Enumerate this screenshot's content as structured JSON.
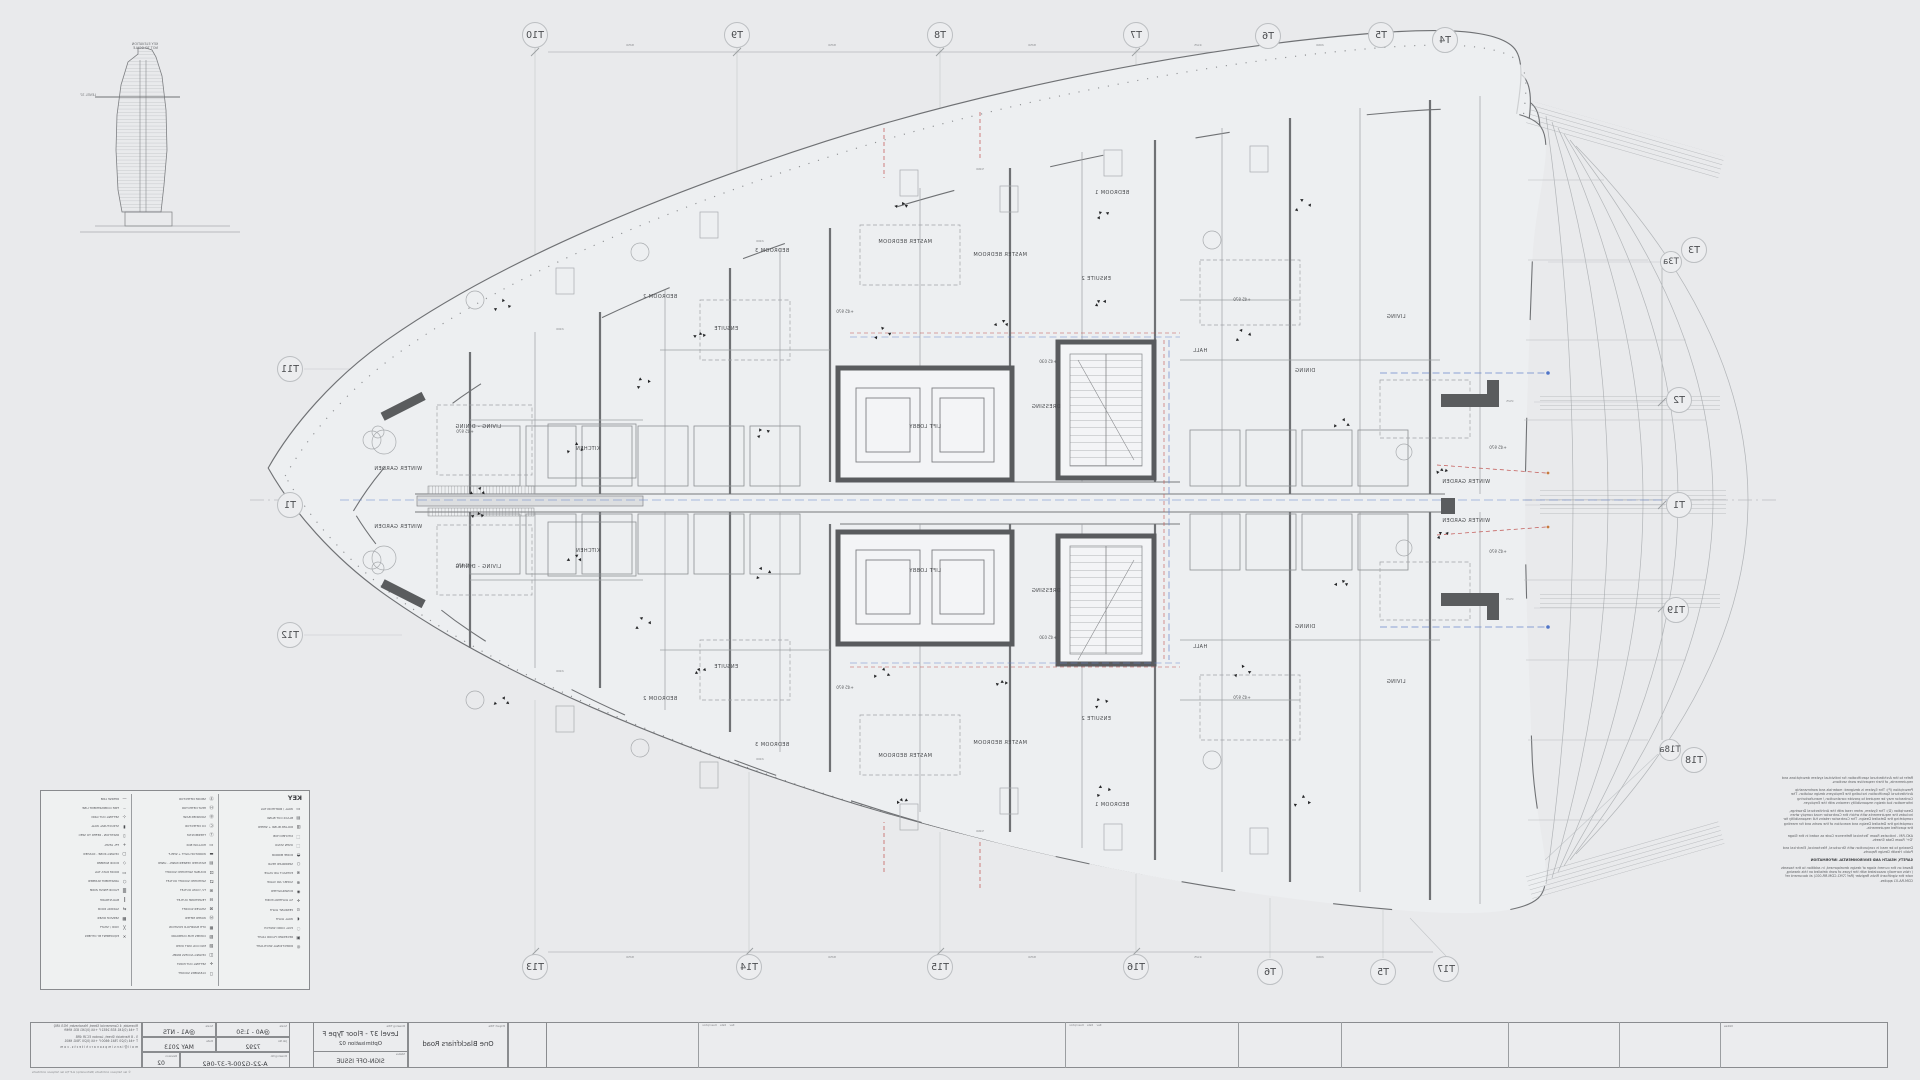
{
  "sheet": {
    "background": "#e9eaec",
    "line_dark": "#6f7174",
    "line_light": "#aeb1b4",
    "accent_blue": "#6a88cc",
    "accent_red": "#c0504d"
  },
  "elevation": {
    "caption_line1": "KEY ELEVATION",
    "caption_line2": "NOT TO SCALE",
    "level_label": "LEVEL 37"
  },
  "grid": {
    "bubbles": [
      {
        "label": "T10",
        "x": 535,
        "y": 35
      },
      {
        "label": "T9",
        "x": 737,
        "y": 35
      },
      {
        "label": "T8",
        "x": 940,
        "y": 35
      },
      {
        "label": "T7",
        "x": 1136,
        "y": 35
      },
      {
        "label": "T6",
        "x": 1268,
        "y": 36
      },
      {
        "label": "T5",
        "x": 1381,
        "y": 35
      },
      {
        "label": "T4",
        "x": 1445,
        "y": 40
      },
      {
        "label": "T3",
        "x": 1694,
        "y": 250
      },
      {
        "label": "T3a",
        "x": 1671,
        "y": 262,
        "small": true
      },
      {
        "label": "T2",
        "x": 1679,
        "y": 400
      },
      {
        "label": "T1",
        "x": 1679,
        "y": 505
      },
      {
        "label": "T19",
        "x": 1676,
        "y": 610
      },
      {
        "label": "T18a",
        "x": 1670,
        "y": 750,
        "small": true
      },
      {
        "label": "T18",
        "x": 1694,
        "y": 760
      },
      {
        "label": "T17",
        "x": 1446,
        "y": 969
      },
      {
        "label": "T13",
        "x": 535,
        "y": 967
      },
      {
        "label": "T14",
        "x": 749,
        "y": 967
      },
      {
        "label": "T15",
        "x": 940,
        "y": 967
      },
      {
        "label": "T16",
        "x": 1136,
        "y": 967
      },
      {
        "label": "T6",
        "x": 1270,
        "y": 972
      },
      {
        "label": "T5",
        "x": 1383,
        "y": 972
      },
      {
        "label": "T11",
        "x": 290,
        "y": 369
      },
      {
        "label": "T1",
        "x": 290,
        "y": 505
      },
      {
        "label": "T12",
        "x": 290,
        "y": 635
      }
    ]
  },
  "plan": {
    "room_labels": [
      {
        "text": "WINTER GARDEN",
        "x": 398,
        "y": 470
      },
      {
        "text": "WINTER GARDEN",
        "x": 398,
        "y": 528
      },
      {
        "text": "LIVING - DINING",
        "x": 478,
        "y": 428
      },
      {
        "text": "LIVING - DINING",
        "x": 478,
        "y": 568
      },
      {
        "text": "KITCHEN",
        "x": 588,
        "y": 450
      },
      {
        "text": "KITCHEN",
        "x": 588,
        "y": 552
      },
      {
        "text": "BEDROOM 2",
        "x": 660,
        "y": 298
      },
      {
        "text": "BEDROOM 2",
        "x": 660,
        "y": 700
      },
      {
        "text": "BEDROOM 3",
        "x": 772,
        "y": 252
      },
      {
        "text": "BEDROOM 3",
        "x": 772,
        "y": 746
      },
      {
        "text": "ENSUITE",
        "x": 726,
        "y": 330
      },
      {
        "text": "ENSUITE",
        "x": 726,
        "y": 668
      },
      {
        "text": "MASTER BEDROOM",
        "x": 905,
        "y": 243
      },
      {
        "text": "MASTER BEDROOM",
        "x": 905,
        "y": 757
      },
      {
        "text": "MASTER BEDROOM",
        "x": 1000,
        "y": 256
      },
      {
        "text": "MASTER BEDROOM",
        "x": 1000,
        "y": 744
      },
      {
        "text": "BEDROOM 1",
        "x": 1112,
        "y": 194
      },
      {
        "text": "BEDROOM 1",
        "x": 1112,
        "y": 806
      },
      {
        "text": "ENSUITE 2",
        "x": 1096,
        "y": 280
      },
      {
        "text": "ENSUITE 2",
        "x": 1096,
        "y": 720
      },
      {
        "text": "DRESSING",
        "x": 1046,
        "y": 408
      },
      {
        "text": "DRESSING",
        "x": 1046,
        "y": 592
      },
      {
        "text": "LIFT LOBBY",
        "x": 925,
        "y": 428
      },
      {
        "text": "LIFT LOBBY",
        "x": 925,
        "y": 572
      },
      {
        "text": "HALL",
        "x": 1200,
        "y": 352
      },
      {
        "text": "HALL",
        "x": 1200,
        "y": 648
      },
      {
        "text": "DINING",
        "x": 1305,
        "y": 372
      },
      {
        "text": "DINING",
        "x": 1305,
        "y": 628
      },
      {
        "text": "LIVING",
        "x": 1396,
        "y": 318
      },
      {
        "text": "LIVING",
        "x": 1396,
        "y": 683
      },
      {
        "text": "WINTER GARDEN",
        "x": 1466,
        "y": 483
      },
      {
        "text": "WINTER GARDEN",
        "x": 1466,
        "y": 522
      }
    ],
    "level_tags": [
      {
        "text": "+45 970",
        "x": 465,
        "y": 432
      },
      {
        "text": "+45 970",
        "x": 465,
        "y": 566
      },
      {
        "text": "+45 970",
        "x": 845,
        "y": 312
      },
      {
        "text": "+45 970",
        "x": 845,
        "y": 688
      },
      {
        "text": "+45 970",
        "x": 1242,
        "y": 300
      },
      {
        "text": "+45 970",
        "x": 1242,
        "y": 698
      },
      {
        "text": "+45 970",
        "x": 1498,
        "y": 448
      },
      {
        "text": "+45 970",
        "x": 1498,
        "y": 552
      },
      {
        "text": "+45 030",
        "x": 1048,
        "y": 362
      },
      {
        "text": "+45 030",
        "x": 1048,
        "y": 638
      }
    ],
    "dim_labels": [
      {
        "text": "8250",
        "x": 630,
        "y": 46
      },
      {
        "text": "8250",
        "x": 832,
        "y": 46
      },
      {
        "text": "8250",
        "x": 1032,
        "y": 46
      },
      {
        "text": "4125",
        "x": 1198,
        "y": 46
      },
      {
        "text": "2060",
        "x": 1320,
        "y": 46
      },
      {
        "text": "8250",
        "x": 630,
        "y": 958
      },
      {
        "text": "8250",
        "x": 832,
        "y": 958
      },
      {
        "text": "8250",
        "x": 1032,
        "y": 958
      },
      {
        "text": "4125",
        "x": 1198,
        "y": 958
      },
      {
        "text": "2060",
        "x": 1320,
        "y": 958
      },
      {
        "text": "2400",
        "x": 560,
        "y": 330
      },
      {
        "text": "2400",
        "x": 760,
        "y": 242
      },
      {
        "text": "5460",
        "x": 980,
        "y": 170
      },
      {
        "text": "2400",
        "x": 560,
        "y": 672
      },
      {
        "text": "2400",
        "x": 760,
        "y": 760
      },
      {
        "text": "5460",
        "x": 980,
        "y": 832
      },
      {
        "text": "1525",
        "x": 1510,
        "y": 402
      },
      {
        "text": "1523",
        "x": 1510,
        "y": 600
      }
    ],
    "symbol_clusters": [
      {
        "x": 575,
        "y": 445
      },
      {
        "x": 575,
        "y": 555
      },
      {
        "x": 700,
        "y": 332
      },
      {
        "x": 700,
        "y": 668
      },
      {
        "x": 762,
        "y": 430
      },
      {
        "x": 762,
        "y": 570
      },
      {
        "x": 882,
        "y": 330
      },
      {
        "x": 882,
        "y": 670
      },
      {
        "x": 1002,
        "y": 320
      },
      {
        "x": 1002,
        "y": 680
      },
      {
        "x": 1100,
        "y": 300
      },
      {
        "x": 1100,
        "y": 700
      },
      {
        "x": 1242,
        "y": 332
      },
      {
        "x": 1242,
        "y": 668
      },
      {
        "x": 1342,
        "y": 420
      },
      {
        "x": 1342,
        "y": 580
      },
      {
        "x": 1442,
        "y": 468
      },
      {
        "x": 1442,
        "y": 532
      },
      {
        "x": 642,
        "y": 380
      },
      {
        "x": 642,
        "y": 620
      },
      {
        "x": 502,
        "y": 302
      },
      {
        "x": 502,
        "y": 698
      },
      {
        "x": 902,
        "y": 202
      },
      {
        "x": 902,
        "y": 798
      },
      {
        "x": 1102,
        "y": 212
      },
      {
        "x": 1102,
        "y": 788
      },
      {
        "x": 1302,
        "y": 202
      },
      {
        "x": 1302,
        "y": 798
      },
      {
        "x": 478,
        "y": 488
      },
      {
        "x": 478,
        "y": 512
      }
    ]
  },
  "key": {
    "title": "KEY",
    "columns": [
      [
        {
          "s": "▭",
          "l": "WALL / PARTITION TAG"
        },
        {
          "s": "▤",
          "l": "BLACK OUT BLIND"
        },
        {
          "s": "▥",
          "l": "ROLLER BLIND + SHEER"
        },
        {
          "s": "⬚",
          "l": "KITCHEN HOB"
        },
        {
          "s": "⬚",
          "l": "OVEN STACK"
        },
        {
          "s": "◒",
          "l": "DOME MIRROR"
        },
        {
          "s": "○",
          "l": "SPRINKLER HEAD"
        },
        {
          "s": "⊗",
          "l": "EXTRACT AIR VALVE"
        },
        {
          "s": "⊕",
          "l": "SUPPLY AIR VALVE"
        },
        {
          "s": "◉",
          "l": "DOWNLIGHTER"
        },
        {
          "s": "✛",
          "l": "5A LIGHTING POINT"
        },
        {
          "s": "⊙",
          "l": "PENDANT LIGHT"
        },
        {
          "s": "◖",
          "l": "WALL LIGHT"
        },
        {
          "s": "◌",
          "l": "PULL CORD SWITCH"
        },
        {
          "s": "▣",
          "l": "RECESSED FLOOR LIGHT"
        },
        {
          "s": "◎",
          "l": "DIRECTIONAL SPOTLIGHT"
        }
      ],
      [
        {
          "s": "Ⓢ",
          "l": "SMOKE DETECTOR"
        },
        {
          "s": "Ⓗ",
          "l": "HEAT DETECTOR"
        },
        {
          "s": "Ⓑ",
          "l": "SOUNDER BASE"
        },
        {
          "s": "Ⓒ",
          "l": "CO DETECTOR"
        },
        {
          "s": "Ⓣ",
          "l": "THERMOSTAT"
        },
        {
          "s": "▭",
          "l": "HOLLOW BOX"
        },
        {
          "s": "▬",
          "l": "WORKTOP LIGHT + SHELF"
        },
        {
          "s": "▤",
          "l": "MATCHED VENEER PANEL - LINED"
        },
        {
          "s": "⚀",
          "l": "DOUBLE SWITCHED SOCKET"
        },
        {
          "s": "⚁",
          "l": "SWITCHED SOCKET OUTLET"
        },
        {
          "s": "⊞",
          "l": "TV / DATA OUTLET"
        },
        {
          "s": "⊟",
          "l": "TELEPHONE OUTLET"
        },
        {
          "s": "⊠",
          "l": "SHAVER SOCKET"
        },
        {
          "s": "Ⓜ",
          "l": "WATER METER"
        },
        {
          "s": "▦",
          "l": "UFH MANIFOLD POSITION"
        },
        {
          "s": "▧",
          "l": "COMMS HUB CUPBOARD"
        },
        {
          "s": "▨",
          "l": "FAN COIL UNIT OVER"
        },
        {
          "s": "◫",
          "l": "CEILING ACCESS PANEL"
        },
        {
          "s": "✛",
          "l": "SETTING OUT POINT"
        },
        {
          "s": "◻",
          "l": "CLEANERS SOCKET"
        }
      ],
      [
        {
          "s": "—",
          "l": "DEMISE LINE"
        },
        {
          "s": "﹘",
          "l": "FIRE COMPARTMENT LINE"
        },
        {
          "s": "⊹",
          "l": "SETTING OUT GRID"
        },
        {
          "s": "▮",
          "l": "STRUCTURAL WALL"
        },
        {
          "s": "▯",
          "l": "PARTITION - REFER TO SPEC"
        },
        {
          "s": "+",
          "l": "FFL LEVEL"
        },
        {
          "s": "▢",
          "l": "CEILING ZONE - DASHED"
        },
        {
          "s": "◇",
          "l": "DOOR NUMBER"
        },
        {
          "s": "▭",
          "l": "ROOM DATA TAG"
        },
        {
          "s": "⬡",
          "l": "APARTMENT NUMBER"
        },
        {
          "s": "▒",
          "l": "FLOOR FINISH ZONE"
        },
        {
          "s": "║",
          "l": "BALUSTRADE"
        },
        {
          "s": "⇄",
          "l": "SLIDING DOOR"
        },
        {
          "s": "▩",
          "l": "SERVICE RISER"
        },
        {
          "s": "╳",
          "l": "VOID / SHAFT"
        },
        {
          "s": "✕",
          "l": "EQUIPMENT BY OTHERS"
        }
      ]
    ]
  },
  "notes": {
    "paragraphs": [
      {
        "text": "Refer to the Architectural specification for individual system descriptions and requirements, of their respective work sections.",
        "bold": false
      },
      {
        "text": "Prescription (P): The System is designed: materials and workmanship Architectural Specification including the Employers design solution. The Contractor may be required to provide construction / manufacturing information but design responsibility remains with the Employer.",
        "bold": false
      },
      {
        "text": "Description (D): The System, when read with the Architectural Drawings, includes the requirements with which the Contractor must comply when completing the Detailed Design. The Contractor retains full responsibility for completing the Detailed Design and execution of the works and for meeting the specified requirements.",
        "bold": false
      },
      {
        "text": "AXO-RM - Indicates Room Technical Reference Code as noted in the Stage 'D+' Room Data Sheets.",
        "bold": false
      },
      {
        "text": "Drawing to be read in conjunction with Structural, Mechanical, Electrical and Public Health Design Reports.",
        "bold": false
      },
      {
        "text": "SAFETY, HEALTH AND ENVIRONMENTAL INFORMATION",
        "bold": true
      },
      {
        "text": "Based on the current stage of design development, in addition to the hazards / risks normally associated with the types of work detailed on this drawing, note the significant Risks Register (Ref 7292-CDM-RR-001) at document ref CDM-RA-01 applies.",
        "bold": false
      }
    ]
  },
  "title_block": {
    "address1_line1": "Riverside, 4 Commercial Street, Manchester, M15 4RQ",
    "address1_line2": "T +44 (0)161 835 2652   F +44 (0)161 831 6969",
    "address2_line1": "5 - 8 Hardwick Street, London EC1R 4RB",
    "address2_line2": "T +44 (0)20 7841 6600   F +44 (0)20 7841 6601",
    "email": "m a i l @ i a n s i m p s o n a r c h i t e c t s . c o m",
    "scale_a1_label": "Scale",
    "scale_a1": "@A1 - NTS",
    "scale_a0_label": "Scale",
    "scale_a0": "@A0 - 1:50",
    "date_label": "Date",
    "date": "MAY 2013",
    "job_label": "Job No",
    "job": "7292",
    "rev_label": "Revision",
    "rev": "02",
    "dwgno_label": "Drawing No",
    "dwgno": "A-22-G200-F-37-062",
    "drawing_title_label": "Drawing Title",
    "drawing_title": "Level 37 - Floor Type F",
    "drawing_subtitle": "Optimisation 02",
    "status_label": "Status",
    "status": "SIGN-OFF ISSUE",
    "project_title_label": "Project Title",
    "project_title": "One Blackfriars Road",
    "rev_cols_label": "Rev    Date    Description",
    "notes_label": "Notes",
    "copyright": "© Ian Simpson Architects (Partnership) LLP T/A Ian Simpson Architects"
  }
}
